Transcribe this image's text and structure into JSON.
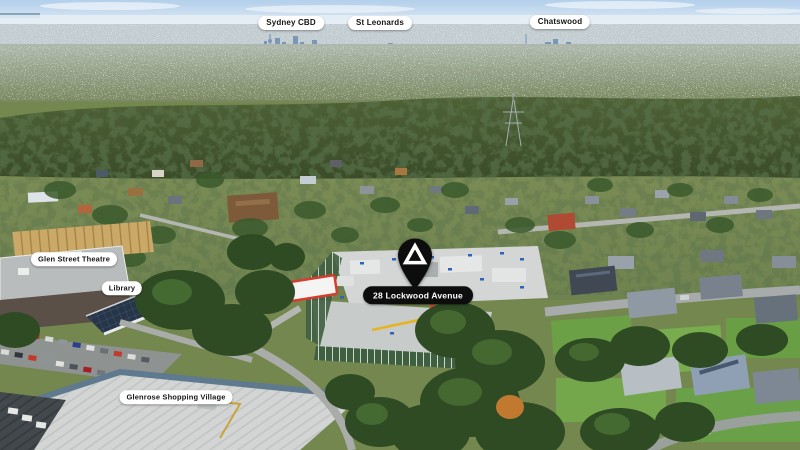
{
  "image_type": "aerial-photograph-location-map",
  "callouts": {
    "skyline": [
      {
        "label": "Sydney CBD"
      },
      {
        "label": "St Leonards"
      },
      {
        "label": "Chatswood"
      }
    ],
    "local": [
      {
        "label": "Glen Street Theatre"
      },
      {
        "label": "Library"
      },
      {
        "label": "Glenrose Shopping Village"
      }
    ]
  },
  "property_pin": {
    "label": "28 Lockwood Avenue",
    "marker": "black-map-pin-with-white-triangle-logo",
    "pin_color": "#0d0d0d",
    "label_bg": "#0d0d0d",
    "label_text_color": "#ffffff"
  },
  "label_style": {
    "bg": "#ffffff",
    "text_color": "#151515"
  },
  "scene_colors": {
    "sky": "#b3cfeb",
    "horizon_haze": "#e6eef4",
    "distant_city": "#7292b4",
    "forest": "#43552f",
    "construction_slab": "#d3d6d4",
    "scaffold_green": "#3f5f41",
    "warehouse_roof": "#d2d5d3",
    "petrol_station_red": "#d63c2f"
  }
}
